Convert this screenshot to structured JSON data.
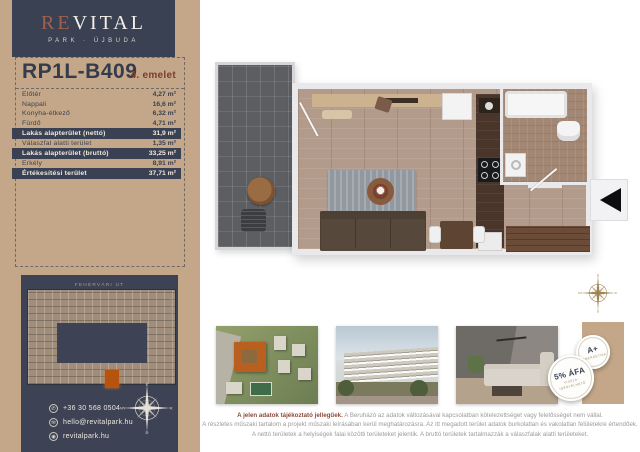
{
  "colors": {
    "sidebar_tan": "#c4a788",
    "navy": "#3a4152",
    "maroon_accent": "#7c3c30",
    "logo_re": "#9b6250",
    "gold": "#a8905f",
    "highlight_orange": "#b5540f",
    "disclaimer_red": "#8e4a3a"
  },
  "brand": {
    "re": "RE",
    "vital": "VITAL",
    "subtitle": "PARK · ÚJBUDA"
  },
  "unit": {
    "code": "RP1L-B409",
    "floor_label": "4. emelet"
  },
  "area_table": {
    "rows": [
      {
        "label": "Előtér",
        "value": "4,27 m²",
        "highlight": false
      },
      {
        "label": "Nappali",
        "value": "16,6 m²",
        "highlight": false
      },
      {
        "label": "Konyha-étkező",
        "value": "6,32 m²",
        "highlight": false
      },
      {
        "label": "Fürdő",
        "value": "4,71 m²",
        "highlight": false
      },
      {
        "label": "Lakás alapterület (nettó)",
        "value": "31,9 m²",
        "highlight": true
      },
      {
        "label": "Válaszfal alatti terület",
        "value": "1,35 m²",
        "highlight": false
      },
      {
        "label": "Lakás alapterület (bruttó)",
        "value": "33,25 m²",
        "highlight": true
      },
      {
        "label": "Erkély",
        "value": "8,91 m²",
        "highlight": false
      },
      {
        "label": "Értékesítési terület",
        "value": "37,71 m²",
        "highlight": true
      }
    ]
  },
  "site_plan": {
    "street_top": "FEHÉRVÁRI ÚT",
    "street_right": "BARÁZDA UTCA"
  },
  "contact": {
    "phone": "+36 30 568 0504",
    "email": "hello@revitalpark.hu",
    "website": "revitalpark.hu"
  },
  "compass": {
    "north": "É",
    "east": "K",
    "south": "D",
    "west": "NY"
  },
  "badges": {
    "energy_rating": "A+",
    "energy_label": "ENERGETIKA",
    "vat_main": "5% ÁFA",
    "vat_sub1": "VISSZA-",
    "vat_sub2": "IGÉNYELHETŐ"
  },
  "disclaimer": {
    "lead": "A jelen adatok tájékoztató jellegűek.",
    "line1_rest": " A Beruházó az adatok változásával kapcsolatban kötelezettséget vagy felelősséget nem vállal.",
    "line2": "A részletes műszaki tartalom a projekt műszaki leírásában kerül meghatározásra. Az itt megadott terület adatok burkolatlan és vakolatlan felületekre értendőek.",
    "line3": "A nettó területek a helyiségek falai közötti területeket jelentik. A bruttó területek tartalmazzák a válaszfalak alatti területeket."
  }
}
